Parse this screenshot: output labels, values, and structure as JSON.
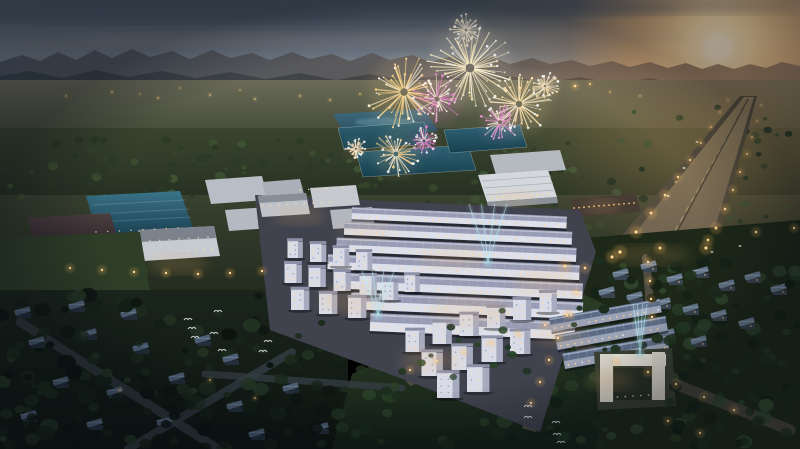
{
  "scene": {
    "description": "Dusk aerial 3D architectural render of a township: fireworks over central lake and factories, sunset at right with lit highway, grid of lavender-roof townhouses with cyan searchlight beams, dark villa neighborhoods and parks below",
    "size": {
      "w": 800,
      "h": 449
    },
    "palette": {
      "sky_top": "#46525f",
      "sky_mid": "#6e7884",
      "horizon_warm": "#c0a58c",
      "sun_core": "#fff8e2",
      "sun_glow": "#f5b96e",
      "mountain": "#49525e",
      "forest": "#2a3622",
      "lawn_dark": "#1521177",
      "road_warm": "#7d6f58",
      "roof_teal": "#2f6375",
      "lake": "#3f6a7e",
      "townhouse_roof": "#979bb4",
      "townhouse_facade": "#dde0eb",
      "window_warm": "#ffd9a2",
      "beam_cyan": "#8fe0ee",
      "firework_gold": "#ffd98f",
      "firework_pink": "#ef8fd4"
    },
    "fireworks": [
      {
        "x": 470,
        "y": 68,
        "r": 44,
        "c": "#ffeec2",
        "c2": "#f7c97e"
      },
      {
        "x": 404,
        "y": 92,
        "r": 38,
        "c": "#ffd98f",
        "c2": "#e8a95f"
      },
      {
        "x": 437,
        "y": 99,
        "r": 26,
        "c": "#ef8fd4",
        "c2": "#c95fb0"
      },
      {
        "x": 519,
        "y": 104,
        "r": 33,
        "c": "#ffe4ad",
        "c2": "#edb273"
      },
      {
        "x": 500,
        "y": 122,
        "r": 20,
        "c": "#ee9cd6",
        "c2": "#cf6cb4"
      },
      {
        "x": 466,
        "y": 30,
        "r": 16,
        "c": "#fff2d4",
        "c2": "#f2d9a0"
      },
      {
        "x": 396,
        "y": 154,
        "r": 24,
        "c": "#f6cf8e",
        "c2": "#da9c5c"
      },
      {
        "x": 424,
        "y": 141,
        "r": 15,
        "c": "#e883cc",
        "c2": "#c05aa8"
      },
      {
        "x": 356,
        "y": 149,
        "r": 11,
        "c": "#f2d7b2",
        "c2": "#d9a878"
      },
      {
        "x": 545,
        "y": 86,
        "r": 14,
        "c": "#f7e3bb",
        "c2": "#e0b680"
      }
    ],
    "beams": [
      {
        "x": 488,
        "y": 262,
        "h": 58,
        "spread": 19
      },
      {
        "x": 378,
        "y": 315,
        "h": 44,
        "spread": 16
      },
      {
        "x": 640,
        "y": 354,
        "h": 50,
        "spread": 7
      }
    ],
    "birds": [
      [
        188,
        320
      ],
      [
        218,
        312
      ],
      [
        192,
        329
      ],
      [
        195,
        338
      ],
      [
        214,
        334
      ],
      [
        222,
        351
      ],
      [
        268,
        342
      ],
      [
        263,
        352
      ],
      [
        528,
        407
      ],
      [
        528,
        418
      ],
      [
        556,
        423
      ],
      [
        557,
        435
      ],
      [
        561,
        443
      ]
    ],
    "distant_lights": [
      [
        66,
        96,
        1
      ],
      [
        112,
        92,
        1
      ],
      [
        158,
        98,
        1
      ],
      [
        210,
        95,
        1
      ],
      [
        255,
        99,
        1
      ],
      [
        300,
        96,
        1
      ],
      [
        330,
        100,
        1
      ],
      [
        360,
        94,
        1
      ],
      [
        420,
        98,
        1
      ],
      [
        470,
        96,
        1
      ],
      [
        520,
        88,
        1.8
      ],
      [
        548,
        90,
        1.2
      ],
      [
        575,
        86,
        2
      ],
      [
        590,
        84,
        1.4
      ],
      [
        610,
        92,
        1
      ],
      [
        640,
        96,
        1
      ],
      [
        240,
        90,
        0.8
      ],
      [
        180,
        88,
        0.8
      ],
      [
        140,
        94,
        0.8
      ],
      [
        430,
        88,
        0.8
      ]
    ],
    "lamps": [
      [
        620,
        252,
        2.3
      ],
      [
        636,
        232,
        2.1
      ],
      [
        651,
        213,
        2.0
      ],
      [
        665,
        195,
        1.8
      ],
      [
        678,
        177,
        1.6
      ],
      [
        690,
        160,
        1.5
      ],
      [
        701,
        143,
        1.3
      ],
      [
        711,
        127,
        1.2
      ],
      [
        720,
        112,
        1.0
      ],
      [
        728,
        100,
        0.9
      ],
      [
        706,
        248,
        2.2
      ],
      [
        716,
        228,
        2.0
      ],
      [
        725,
        209,
        1.8
      ],
      [
        733,
        190,
        1.6
      ],
      [
        740,
        172,
        1.5
      ],
      [
        747,
        154,
        1.3
      ],
      [
        752,
        137,
        1.2
      ],
      [
        757,
        121,
        1.0
      ],
      [
        761,
        105,
        0.9
      ],
      [
        565,
        266,
        2.2
      ],
      [
        612,
        257,
        2.1
      ],
      [
        660,
        248,
        2.0
      ],
      [
        708,
        240,
        1.8
      ],
      [
        756,
        232,
        1.7
      ],
      [
        794,
        228,
        1.6
      ],
      [
        70,
        268,
        1.6
      ],
      [
        102,
        270,
        1.6
      ],
      [
        134,
        272,
        1.6
      ],
      [
        166,
        273,
        1.6
      ],
      [
        198,
        274,
        1.6
      ],
      [
        230,
        273,
        1.6
      ],
      [
        262,
        271,
        1.6
      ],
      [
        585,
        268,
        1.8
      ],
      [
        576,
        292,
        1.8
      ],
      [
        567,
        315,
        1.7
      ],
      [
        558,
        338,
        1.7
      ],
      [
        549,
        360,
        1.6
      ],
      [
        540,
        382,
        1.6
      ],
      [
        531,
        403,
        1.6
      ],
      [
        410,
        370,
        1.5
      ],
      [
        437,
        361,
        1.5
      ],
      [
        464,
        352,
        1.5
      ],
      [
        491,
        343,
        1.5
      ],
      [
        518,
        334,
        1.5
      ],
      [
        545,
        325,
        1.5
      ],
      [
        571,
        315,
        1.5
      ],
      [
        616,
        362,
        1.7
      ],
      [
        648,
        372,
        1.7
      ],
      [
        676,
        384,
        1.7
      ],
      [
        704,
        397,
        1.7
      ],
      [
        734,
        410,
        1.7
      ],
      [
        668,
        421,
        1.6
      ],
      [
        700,
        433,
        1.6
      ],
      [
        648,
        262,
        1.6
      ],
      [
        650,
        281,
        1.6
      ],
      [
        651,
        299,
        1.6
      ],
      [
        652,
        317,
        1.6
      ],
      [
        120,
        390,
        1.0
      ],
      [
        210,
        380,
        1.0
      ],
      [
        255,
        398,
        1.0
      ]
    ],
    "glow_spots": [
      [
        178,
        264,
        30,
        10
      ],
      [
        300,
        216,
        26,
        9
      ],
      [
        366,
        231,
        28,
        9
      ],
      [
        452,
        258,
        34,
        11
      ],
      [
        516,
        198,
        22,
        8
      ],
      [
        602,
        206,
        18,
        7
      ],
      [
        352,
        300,
        34,
        14
      ],
      [
        470,
        310,
        40,
        16
      ],
      [
        545,
        282,
        34,
        13
      ],
      [
        430,
        360,
        30,
        12
      ],
      [
        560,
        335,
        26,
        11
      ],
      [
        610,
        380,
        24,
        10
      ],
      [
        650,
        255,
        40,
        10
      ]
    ],
    "tree_regions": [
      {
        "x": 0,
        "y": 295,
        "w": 345,
        "h": 154,
        "n": 110,
        "rmin": 3.5,
        "rmax": 10,
        "seed": 11,
        "layer": 1,
        "colors": [
          "#0d1611",
          "#152118",
          "#1c2b1d",
          "#243524"
        ]
      },
      {
        "x": 330,
        "y": 330,
        "w": 290,
        "h": 119,
        "n": 70,
        "rmin": 3,
        "rmax": 9,
        "seed": 21,
        "layer": 1,
        "colors": [
          "#122015",
          "#1a2c1c",
          "#223621",
          "#2a4027"
        ]
      },
      {
        "x": 596,
        "y": 256,
        "w": 204,
        "h": 193,
        "n": 95,
        "rmin": 3,
        "rmax": 8.5,
        "seed": 31,
        "layer": 1,
        "colors": [
          "#142217",
          "#1d2f1e",
          "#273c25",
          "#31482c"
        ]
      },
      {
        "x": 0,
        "y": 138,
        "w": 340,
        "h": 64,
        "n": 70,
        "rmin": 2,
        "rmax": 5.5,
        "seed": 41,
        "layer": 0,
        "colors": [
          "#2b3824",
          "#35452b",
          "#3f5232",
          "#2a3a26"
        ]
      },
      {
        "x": 320,
        "y": 148,
        "w": 250,
        "h": 68,
        "n": 45,
        "rmin": 2,
        "rmax": 5,
        "seed": 51,
        "layer": 0,
        "colors": [
          "#2b3a26",
          "#37482d",
          "#415434"
        ]
      },
      {
        "x": 560,
        "y": 104,
        "w": 240,
        "h": 130,
        "n": 55,
        "rmin": 2,
        "rmax": 5,
        "seed": 61,
        "layer": 0,
        "colors": [
          "#333f29",
          "#3e4c2f",
          "#495838",
          "#2c3824"
        ]
      },
      {
        "x": 0,
        "y": 238,
        "w": 150,
        "h": 70,
        "n": 22,
        "rmin": 2.5,
        "rmax": 6,
        "seed": 71,
        "layer": 0,
        "colors": [
          "#22301f",
          "#2b3b26",
          "#354830"
        ]
      },
      {
        "x": 255,
        "y": 182,
        "w": 150,
        "h": 60,
        "n": 20,
        "rmin": 2,
        "rmax": 4.5,
        "seed": 81,
        "layer": 0,
        "colors": [
          "#2c3b26",
          "#374a2e"
        ]
      },
      {
        "x": 0,
        "y": 300,
        "w": 340,
        "h": 149,
        "n": 45,
        "rmin": 3,
        "rmax": 8,
        "seed": 91,
        "layer": 2,
        "colors": [
          "#0c1410",
          "#131f15",
          "#1a2a1b"
        ]
      },
      {
        "x": 600,
        "y": 262,
        "w": 200,
        "h": 180,
        "n": 35,
        "rmin": 2.5,
        "rmax": 7,
        "seed": 92,
        "layer": 2,
        "colors": [
          "#121f15",
          "#1a2b1b",
          "#223520"
        ]
      },
      {
        "x": 395,
        "y": 300,
        "w": 185,
        "h": 78,
        "n": 16,
        "rmin": 2.5,
        "rmax": 5,
        "seed": 93,
        "layer": 2,
        "colors": [
          "#1e3322",
          "#28422a"
        ]
      }
    ],
    "townhouse_block": {
      "rotate": 2.5,
      "origin": [
        350,
        210
      ],
      "rows": [
        {
          "x": 352,
          "y": 207,
          "w": 215,
          "h": 12
        },
        {
          "x": 345,
          "y": 222,
          "w": 228,
          "h": 13
        },
        {
          "x": 338,
          "y": 238,
          "w": 240,
          "h": 14
        },
        {
          "x": 330,
          "y": 255,
          "w": 252,
          "h": 15
        },
        {
          "x": 340,
          "y": 273,
          "w": 246,
          "h": 16
        },
        {
          "x": 355,
          "y": 292,
          "w": 232,
          "h": 17
        },
        {
          "x": 375,
          "y": 312,
          "w": 205,
          "h": 18
        }
      ],
      "style": {
        "roof": "#979bb4",
        "ridge": "#cacdde",
        "facade": "#dde0eb",
        "window": "#ffd9a2"
      }
    },
    "subblock": {
      "rotate": -10,
      "origin": [
        549,
        318
      ],
      "rows": [
        {
          "x": 549,
          "y": 318,
          "w": 112,
          "h": 14
        },
        {
          "x": 552,
          "y": 336,
          "w": 112,
          "h": 15
        },
        {
          "x": 556,
          "y": 355,
          "w": 106,
          "h": 16
        }
      ],
      "style": {
        "roof": "#5b6a84",
        "ridge": "#aebbd0",
        "facade": "#9aa2b6",
        "window": "#ffcf92"
      }
    },
    "cubes": [
      [
        295,
        258,
        15
      ],
      [
        318,
        262,
        16
      ],
      [
        341,
        266,
        16
      ],
      [
        364,
        270,
        16
      ],
      [
        293,
        283,
        17
      ],
      [
        317,
        287,
        17
      ],
      [
        342,
        291,
        17
      ],
      [
        368,
        295,
        17
      ],
      [
        300,
        310,
        18
      ],
      [
        328,
        314,
        18
      ],
      [
        357,
        318,
        18
      ],
      [
        390,
        300,
        16
      ],
      [
        412,
        292,
        15
      ],
      [
        415,
        352,
        19
      ],
      [
        442,
        344,
        19
      ],
      [
        469,
        336,
        19
      ],
      [
        496,
        328,
        18
      ],
      [
        522,
        320,
        18
      ],
      [
        548,
        312,
        17
      ],
      [
        432,
        376,
        21
      ],
      [
        462,
        370,
        21
      ],
      [
        492,
        362,
        21
      ],
      [
        520,
        354,
        20
      ],
      [
        448,
        398,
        22
      ],
      [
        478,
        392,
        22
      ]
    ],
    "villas_left": [
      [
        38,
        346
      ],
      [
        90,
        338
      ],
      [
        142,
        352
      ],
      [
        62,
        386
      ],
      [
        116,
        396
      ],
      [
        178,
        382
      ],
      [
        232,
        363
      ],
      [
        30,
        420
      ],
      [
        96,
        428
      ],
      [
        166,
        426
      ],
      [
        236,
        410
      ],
      [
        292,
        392
      ],
      [
        322,
        432
      ],
      [
        258,
        438
      ],
      [
        204,
        344
      ],
      [
        24,
        316
      ],
      [
        78,
        310
      ],
      [
        130,
        318
      ]
    ],
    "villas_right": [
      [
        622,
        278
      ],
      [
        650,
        270
      ],
      [
        676,
        283
      ],
      [
        702,
        276
      ],
      [
        728,
        289
      ],
      [
        754,
        281
      ],
      [
        780,
        293
      ],
      [
        636,
        301
      ],
      [
        664,
        307
      ],
      [
        692,
        313
      ],
      [
        720,
        319
      ],
      [
        748,
        327
      ],
      [
        640,
        332
      ],
      [
        608,
        296
      ],
      [
        668,
        338
      ],
      [
        700,
        345
      ]
    ],
    "dot_rows": [
      {
        "x1": 492,
        "y1": 198,
        "x2": 548,
        "y2": 194,
        "n": 11,
        "r": 0.9,
        "c": "#ffd9a2"
      },
      {
        "x1": 574,
        "y1": 208,
        "x2": 634,
        "y2": 203,
        "n": 13,
        "r": 0.9,
        "c": "#ffc87e"
      },
      {
        "x1": 146,
        "y1": 253,
        "x2": 212,
        "y2": 249,
        "n": 9,
        "r": 0.8,
        "c": "#ffd9a2"
      },
      {
        "x1": 150,
        "y1": 241,
        "x2": 208,
        "y2": 237,
        "n": 7,
        "r": 0.7,
        "c": "#ffe2b0"
      },
      {
        "x1": 262,
        "y1": 206,
        "x2": 330,
        "y2": 202,
        "n": 9,
        "r": 0.8,
        "c": "#ffd9a2"
      },
      {
        "x1": 300,
        "y1": 190,
        "x2": 352,
        "y2": 187,
        "n": 7,
        "r": 0.7,
        "c": "#ffd9a2"
      },
      {
        "x1": 602,
        "y1": 398,
        "x2": 664,
        "y2": 394,
        "n": 9,
        "r": 0.8,
        "c": "#ffd9a2"
      },
      {
        "x1": 96,
        "y1": 232,
        "x2": 178,
        "y2": 228,
        "n": 8,
        "r": 0.7,
        "c": "#f8d8a0"
      }
    ],
    "vehicles": [
      [
        668,
        196,
        "#f3e9d2"
      ],
      [
        684,
        168,
        "#f3e9d2"
      ],
      [
        697,
        142,
        "#e8dcc4"
      ],
      [
        676,
        182,
        "#d8b489"
      ],
      [
        740,
        246,
        "#e9e2cf"
      ],
      [
        712,
        252,
        "#d8cdb6"
      ]
    ]
  }
}
